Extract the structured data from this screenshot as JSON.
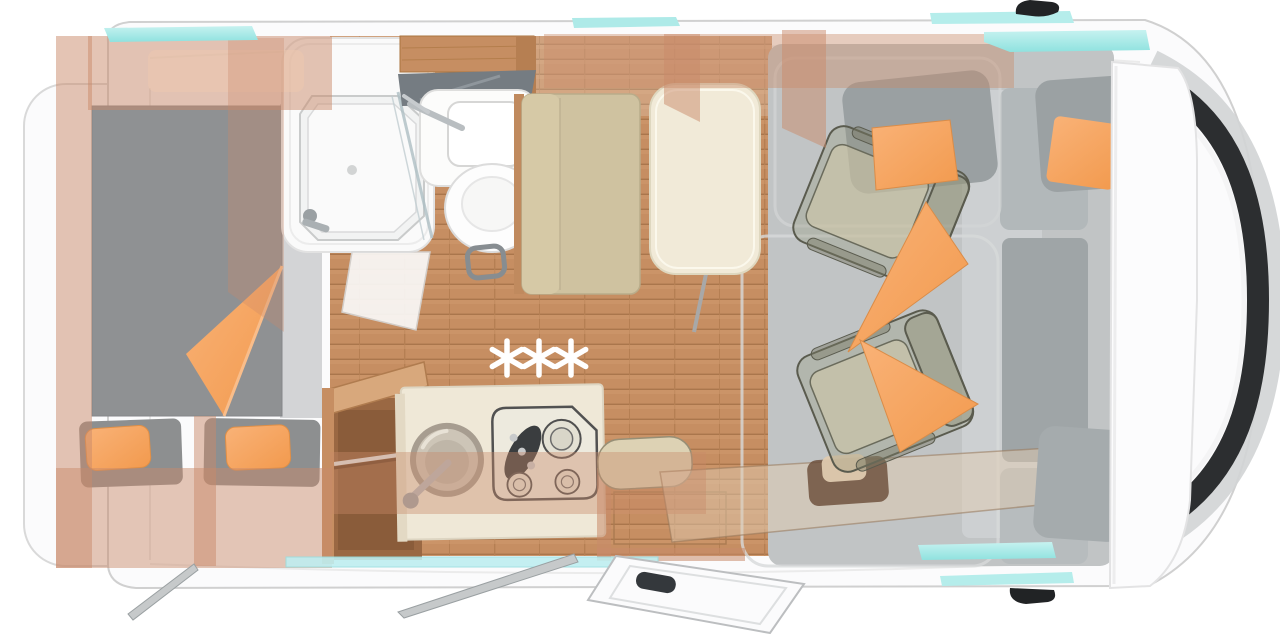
{
  "scene": {
    "kind": "motorhome-floor-plan-top-view",
    "visible_text": "✳✳✳"
  },
  "decorations": {
    "stars": "✳✳✳"
  },
  "palette": {
    "body-white": "#fbfbfc",
    "body-edge": "#d6d7d8",
    "glass-cyan": "#9fe8e5",
    "glass-cyan-light": "#c6f2f0",
    "windshield-dark": "#2c2e30",
    "mirror-black": "#212325",
    "wall-tint": "#c98a6a",
    "wood": "#c68e62",
    "wood-dark": "#aa764c",
    "wood-light": "#d8a87c",
    "mattress-gray": "#8f9193",
    "accent-orange": "#f7a55e",
    "cushion-khaki": "#cfc2a0",
    "table-cream": "#f1ead8",
    "counter-cream": "#efe8d7",
    "carpet-gray": "#c1c4c5",
    "star-white": "#ffffff"
  },
  "elements": [
    "van-body",
    "rear-bumper",
    "double-bed",
    "bed-blanket",
    "bed-pillows",
    "shower-cabin",
    "washbasin",
    "toilet",
    "bathroom-mirror",
    "wardrobe",
    "kitchen-sink",
    "gas-hob",
    "dinette-table",
    "dinette-bench",
    "swivel-seat-front",
    "swivel-seat-rear",
    "cab-carpet",
    "dashboard",
    "entry-door",
    "entry-step",
    "windshield",
    "side-mirror-top",
    "side-mirror-bottom",
    "windows",
    "awning-rail",
    "support-legs",
    "three-stars-decoration"
  ]
}
